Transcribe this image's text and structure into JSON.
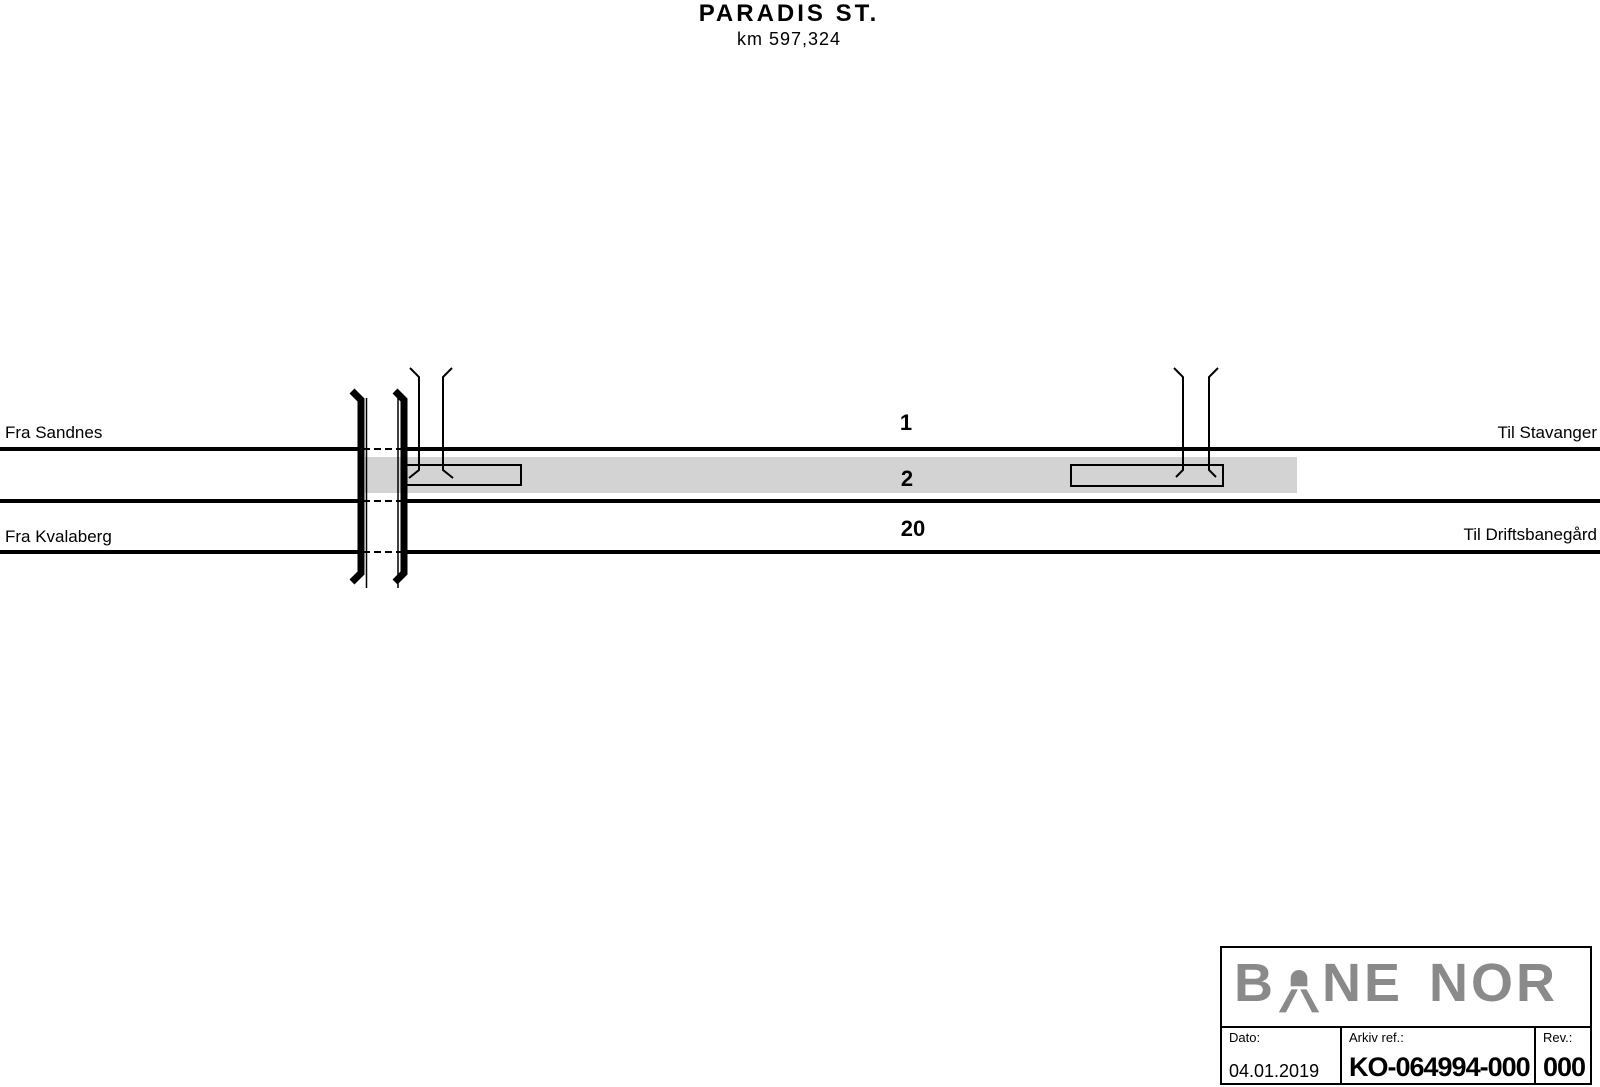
{
  "header": {
    "station": "PARADIS ST.",
    "km": "km 597,324"
  },
  "endpoints": {
    "left_top": "Fra Sandnes",
    "left_bottom": "Fra Kvalaberg",
    "right_top": "Til Stavanger",
    "right_bottom": "Til Driftsbanegård"
  },
  "track_numbers": {
    "track1": "1",
    "track2": "2",
    "track20": "20"
  },
  "title_block": {
    "logo_part1": "B",
    "logo_part2": "NE",
    "logo_part3": "NOR",
    "date_label": "Dato:",
    "date_value": "04.01.2019",
    "archive_label": "Arkiv ref.:",
    "archive_value": "KO-064994-000",
    "rev_label": "Rev.:",
    "rev_value": "000"
  },
  "colors": {
    "ink": "#000000",
    "platform_band": "#d3d3d3",
    "logo_gray": "#8a8a8a"
  }
}
